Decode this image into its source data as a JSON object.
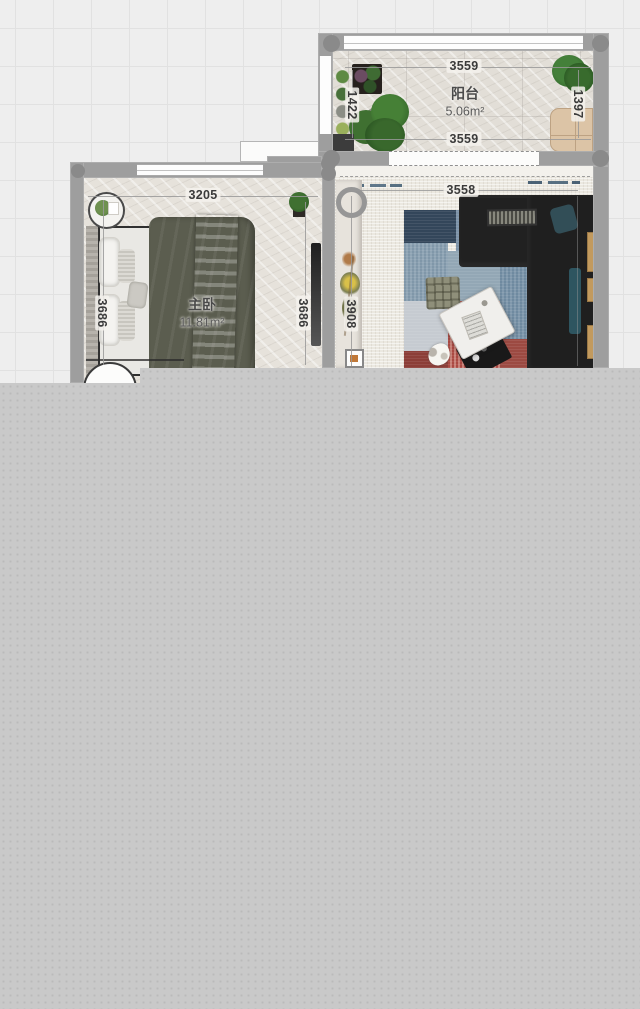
{
  "canvas": {
    "background": "#eeeeee",
    "grid_line": "#e1e1e1",
    "unrendered_area": "#c9c9c9",
    "wall_color": "#9e9e9e"
  },
  "rooms": {
    "balcony": {
      "name": "阳台",
      "area": "5.06m²",
      "dims": {
        "top": "3559",
        "bottom": "3559",
        "left": "1422",
        "right": "1397"
      }
    },
    "master_bedroom": {
      "name": "主卧",
      "area": "11.81m²",
      "dims": {
        "top": "3205",
        "left": "3686",
        "right": "3686"
      }
    },
    "living_room": {
      "dims": {
        "top": "3558",
        "left": "3908"
      }
    }
  },
  "furniture": {
    "balcony": [
      "potted-plant-shelf",
      "planter-box",
      "large-plant",
      "large-plant",
      "storage-cabinet",
      "floor-unit"
    ],
    "master_bedroom": [
      "round-side-table",
      "double-bed",
      "potted-plant",
      "wardrobe",
      "door-swing"
    ],
    "living_room": [
      "wall-ring-decor",
      "flower-vase",
      "picture-frame",
      "sectional-sofa",
      "striped-cushion",
      "teal-pillow",
      "patchwork-rug",
      "plaid-ottoman",
      "coffee-table",
      "black-side-table",
      "pet-cat",
      "wood-slat-shelf"
    ]
  },
  "accent_colors": {
    "sofa": "#1f1f1f",
    "duvet": "#5b5d4f",
    "rug_red": "#ab4a43",
    "rug_blue": "#54718a",
    "teal_pillow": "#2e5560",
    "cabinet_beige": "#dcc4a6",
    "plant_green": "#356229"
  }
}
